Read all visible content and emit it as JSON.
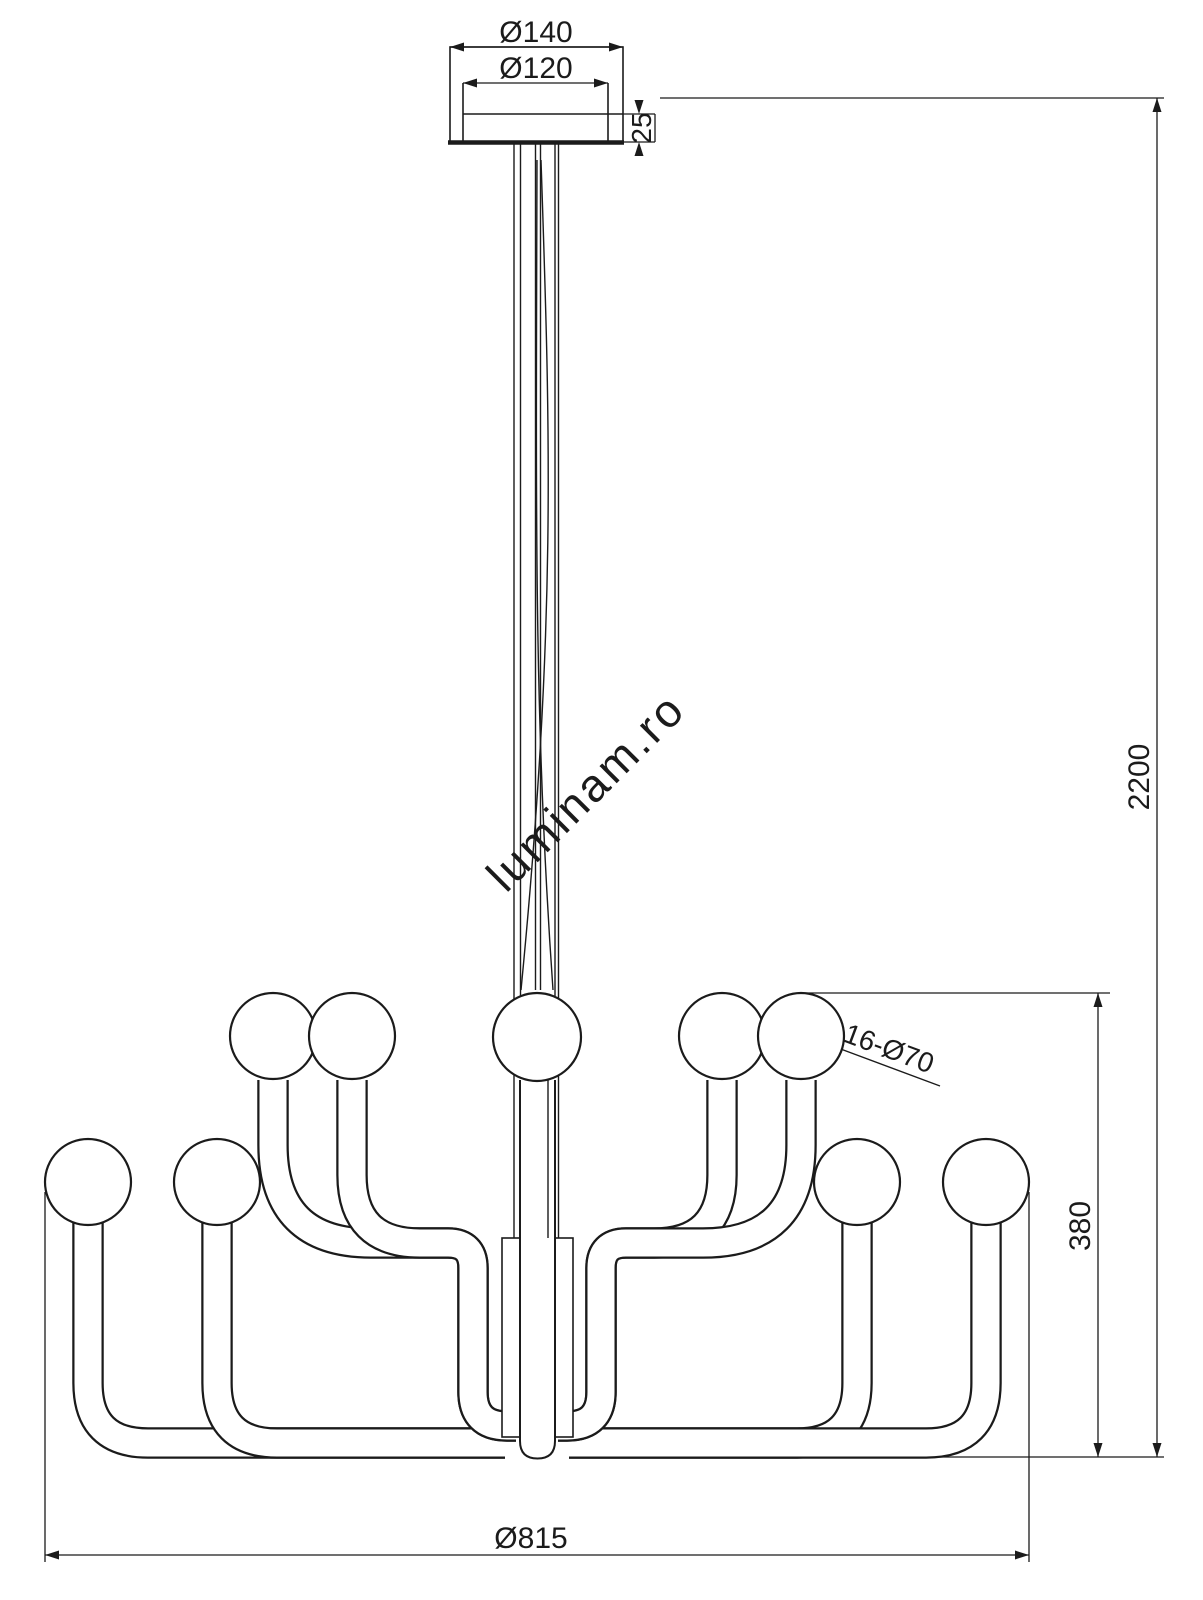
{
  "drawing": {
    "title": "chandelier-dimension-drawing",
    "watermark": "luminam.ro",
    "colors": {
      "ink": "#1b1b1b",
      "watermark": "#c9c9c9",
      "background": "#ffffff"
    },
    "dimensions": {
      "canopy_outer_diameter": "Ø140",
      "canopy_inner_diameter": "Ø120",
      "canopy_height": "25",
      "overall_drop": "2200",
      "body_height": "380",
      "bulb_count_and_diameter": "16-Ø70",
      "overall_diameter": "Ø815"
    }
  }
}
